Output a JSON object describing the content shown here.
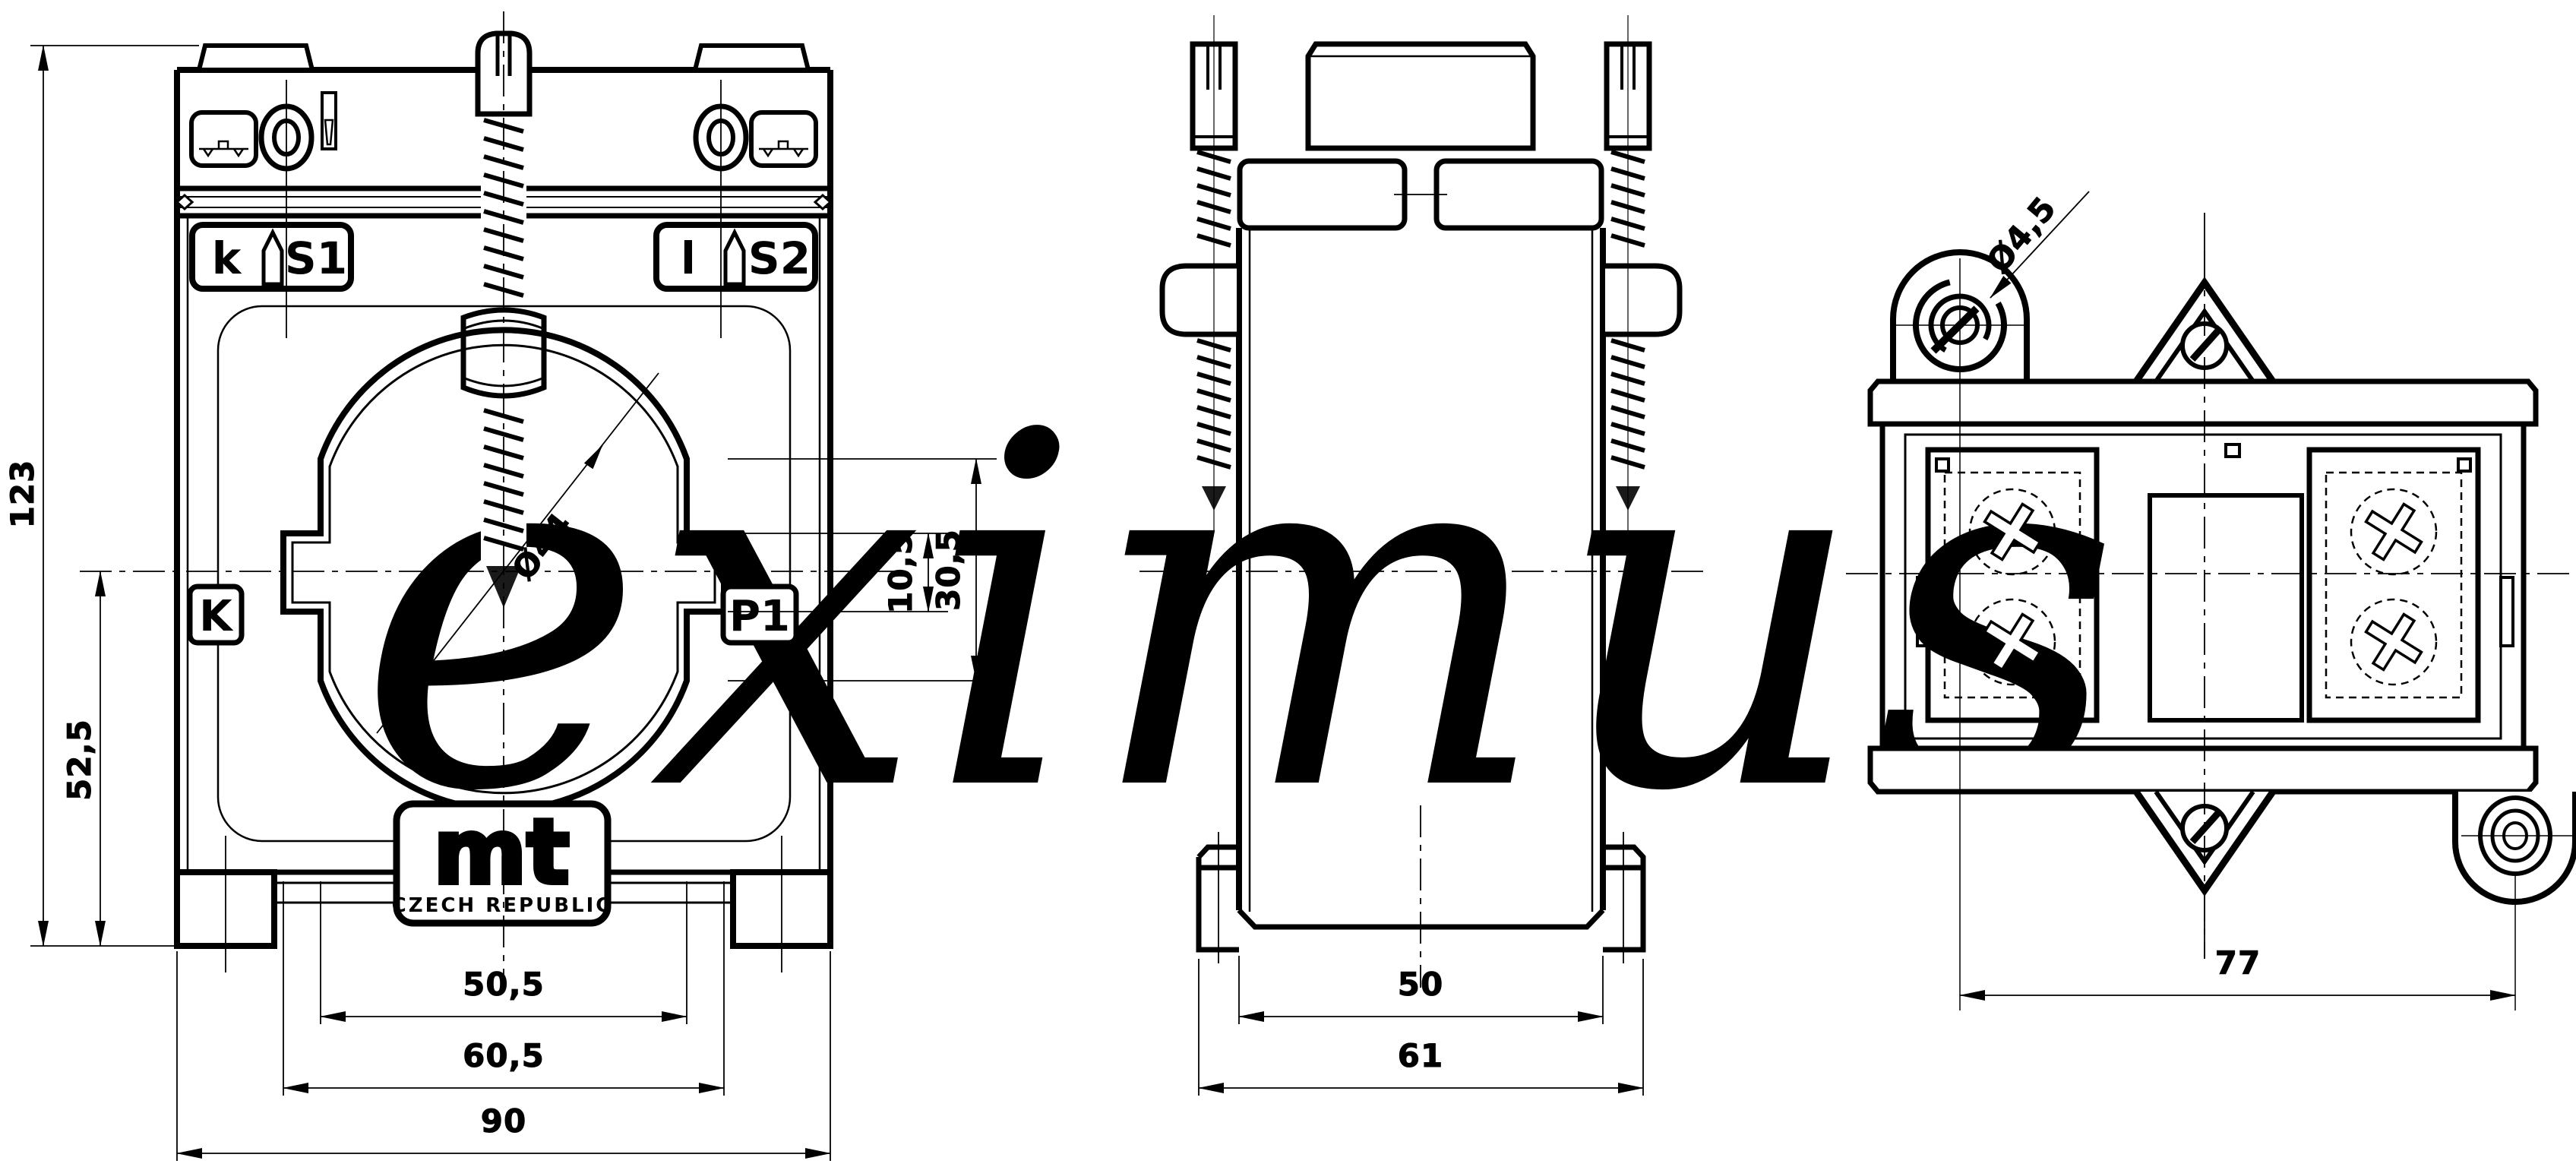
{
  "drawing": {
    "background": "#ffffff",
    "line_color": "#000000",
    "watermark": {
      "text": "eximus",
      "registered_mark": "®",
      "color": "#e9e9e9"
    },
    "front_view": {
      "terminals": {
        "left_lower": "k",
        "left_upper": "S1",
        "right_lower": "l",
        "right_upper": "S2"
      },
      "winding_labels": {
        "left": "K",
        "right": "P1"
      },
      "logo": {
        "brand": "mt",
        "origin": "CZECH REPUBLIC"
      },
      "dims": {
        "overall_height": "123",
        "center_to_base": "52,5",
        "aperture_diameter": "Ø44",
        "window_height_inner": "10,5",
        "window_height_outer": "30,5",
        "window_width_inner": "50,5",
        "window_width_outer": "60,5",
        "overall_width": "90"
      }
    },
    "side_view": {
      "dims": {
        "body_depth": "50",
        "overall_depth": "61"
      }
    },
    "rear_view": {
      "dims": {
        "mounting_hole_diameter": "Ø4,5",
        "mounting_hole_spacing": "77"
      }
    }
  }
}
